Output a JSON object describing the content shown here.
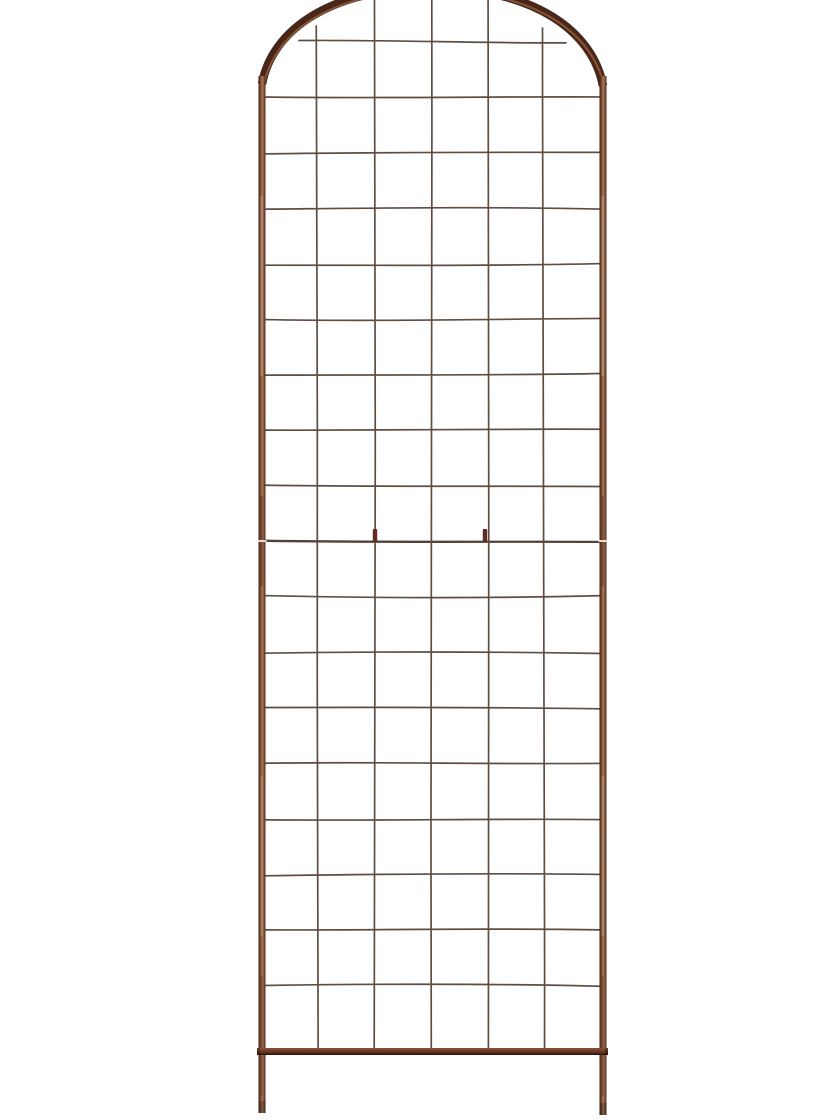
{
  "meta": {
    "alt": "Rust-brown metal grid panel trellis with arched top, ground-stake legs and white background",
    "background_color": "#ffffff"
  },
  "trellis": {
    "colors": {
      "frame_dark": "#3f2014",
      "frame_mid": "#7a4a32",
      "frame_light": "#a87a58",
      "frame_deep": "#502a1a",
      "arch": "#4a2618",
      "arch_highlight": "#8a5c40",
      "bar_top": "#8a5238",
      "bar_mid": "#6e3a26",
      "bar_bottom": "#3f1f12",
      "wire": "#5f4d44",
      "joint_wire": "#53413a",
      "clip": "#5e2a21",
      "seam": "#f2ece6"
    },
    "geometry": {
      "canvas": {
        "width": 840,
        "height": 1120
      },
      "rail_left_x": 262,
      "rail_right_x": 603,
      "rail_width": 7,
      "rail_top_y": 76,
      "leg_bottom_left_y": 1113,
      "leg_bottom_right_y": 1115,
      "arch_base_y": 84,
      "arch_apex_y": -12,
      "bar_left": 257,
      "bar_right": 608,
      "bar_y": 1048,
      "bar_height": 7,
      "joint_y": 541,
      "clips_x": [
        375,
        485
      ],
      "grid": {
        "verticals_x": [
          317,
          374.5,
          432,
          488.5,
          543.5
        ],
        "verticals_top_y": [
          26,
          0,
          0,
          0,
          28
        ],
        "verticals_bottom_y": 1049,
        "horizontals_first_y": 42,
        "horizontals_step": 55.5,
        "horizontals_count": 18,
        "joint_row_index": 9,
        "top_row_left_x": 299,
        "top_row_right_x": 566,
        "wire_width": 1.7,
        "joint_wire_width": 2.3,
        "columns": 6,
        "rows": 18
      }
    }
  }
}
